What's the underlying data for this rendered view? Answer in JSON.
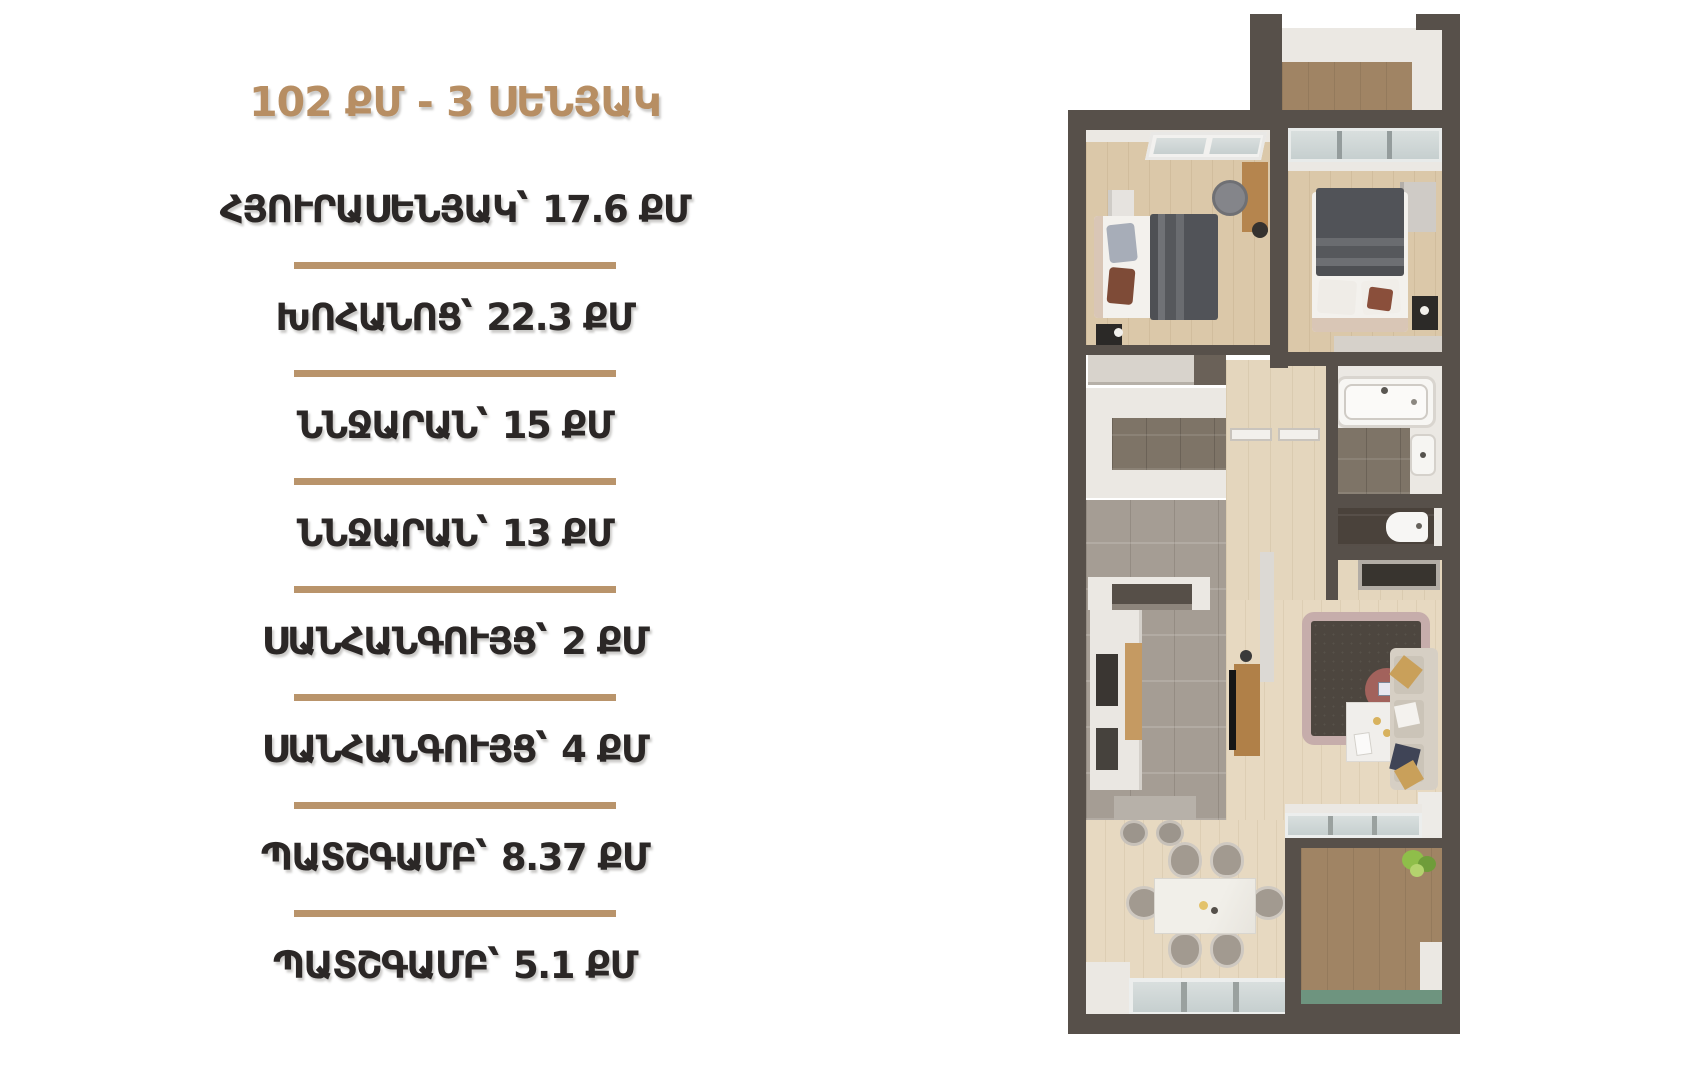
{
  "header": {
    "title": "102 ՔՄ - 3 ՍԵՆՅԱԿ"
  },
  "rooms": [
    {
      "name": "ՀՅՈՒՐԱՍԵՆՅԱԿ՝",
      "area": "17.6 ՔՄ"
    },
    {
      "name": "ԽՈՀԱՆՈՑ՝",
      "area": "22.3 ՔՄ"
    },
    {
      "name": "ՆՆՋԱՐԱՆ՝",
      "area": "15 ՔՄ"
    },
    {
      "name": "ՆՆՋԱՐԱՆ՝",
      "area": "13 ՔՄ"
    },
    {
      "name": "ՍԱՆՀԱՆԳՈՒՅՑ՝",
      "area": "2 ՔՄ"
    },
    {
      "name": "ՍԱՆՀԱՆԳՈՒՅՑ՝",
      "area": "4 ՔՄ"
    },
    {
      "name": "ՊԱՏՇԳԱՄԲ՝",
      "area": "8.37 ՔՄ"
    },
    {
      "name": "ՊԱՏՇԳԱՄԲ՝",
      "area": "5.1 ՔՄ"
    }
  ],
  "palette": {
    "accent": "#b78e63",
    "divider": "#b9946b",
    "text": "#2b2726",
    "wall": "#57504a",
    "wood": "#dbc8a9",
    "wood_light": "#e7d9c1",
    "kitchen_tile": "#a59d94",
    "bath_tile": "#7e7467",
    "dark_tile": "#4a423b",
    "balcony_floor": "#a0846a",
    "balcony_green": "#6e947f",
    "white_wall": "#ebe8e3"
  }
}
